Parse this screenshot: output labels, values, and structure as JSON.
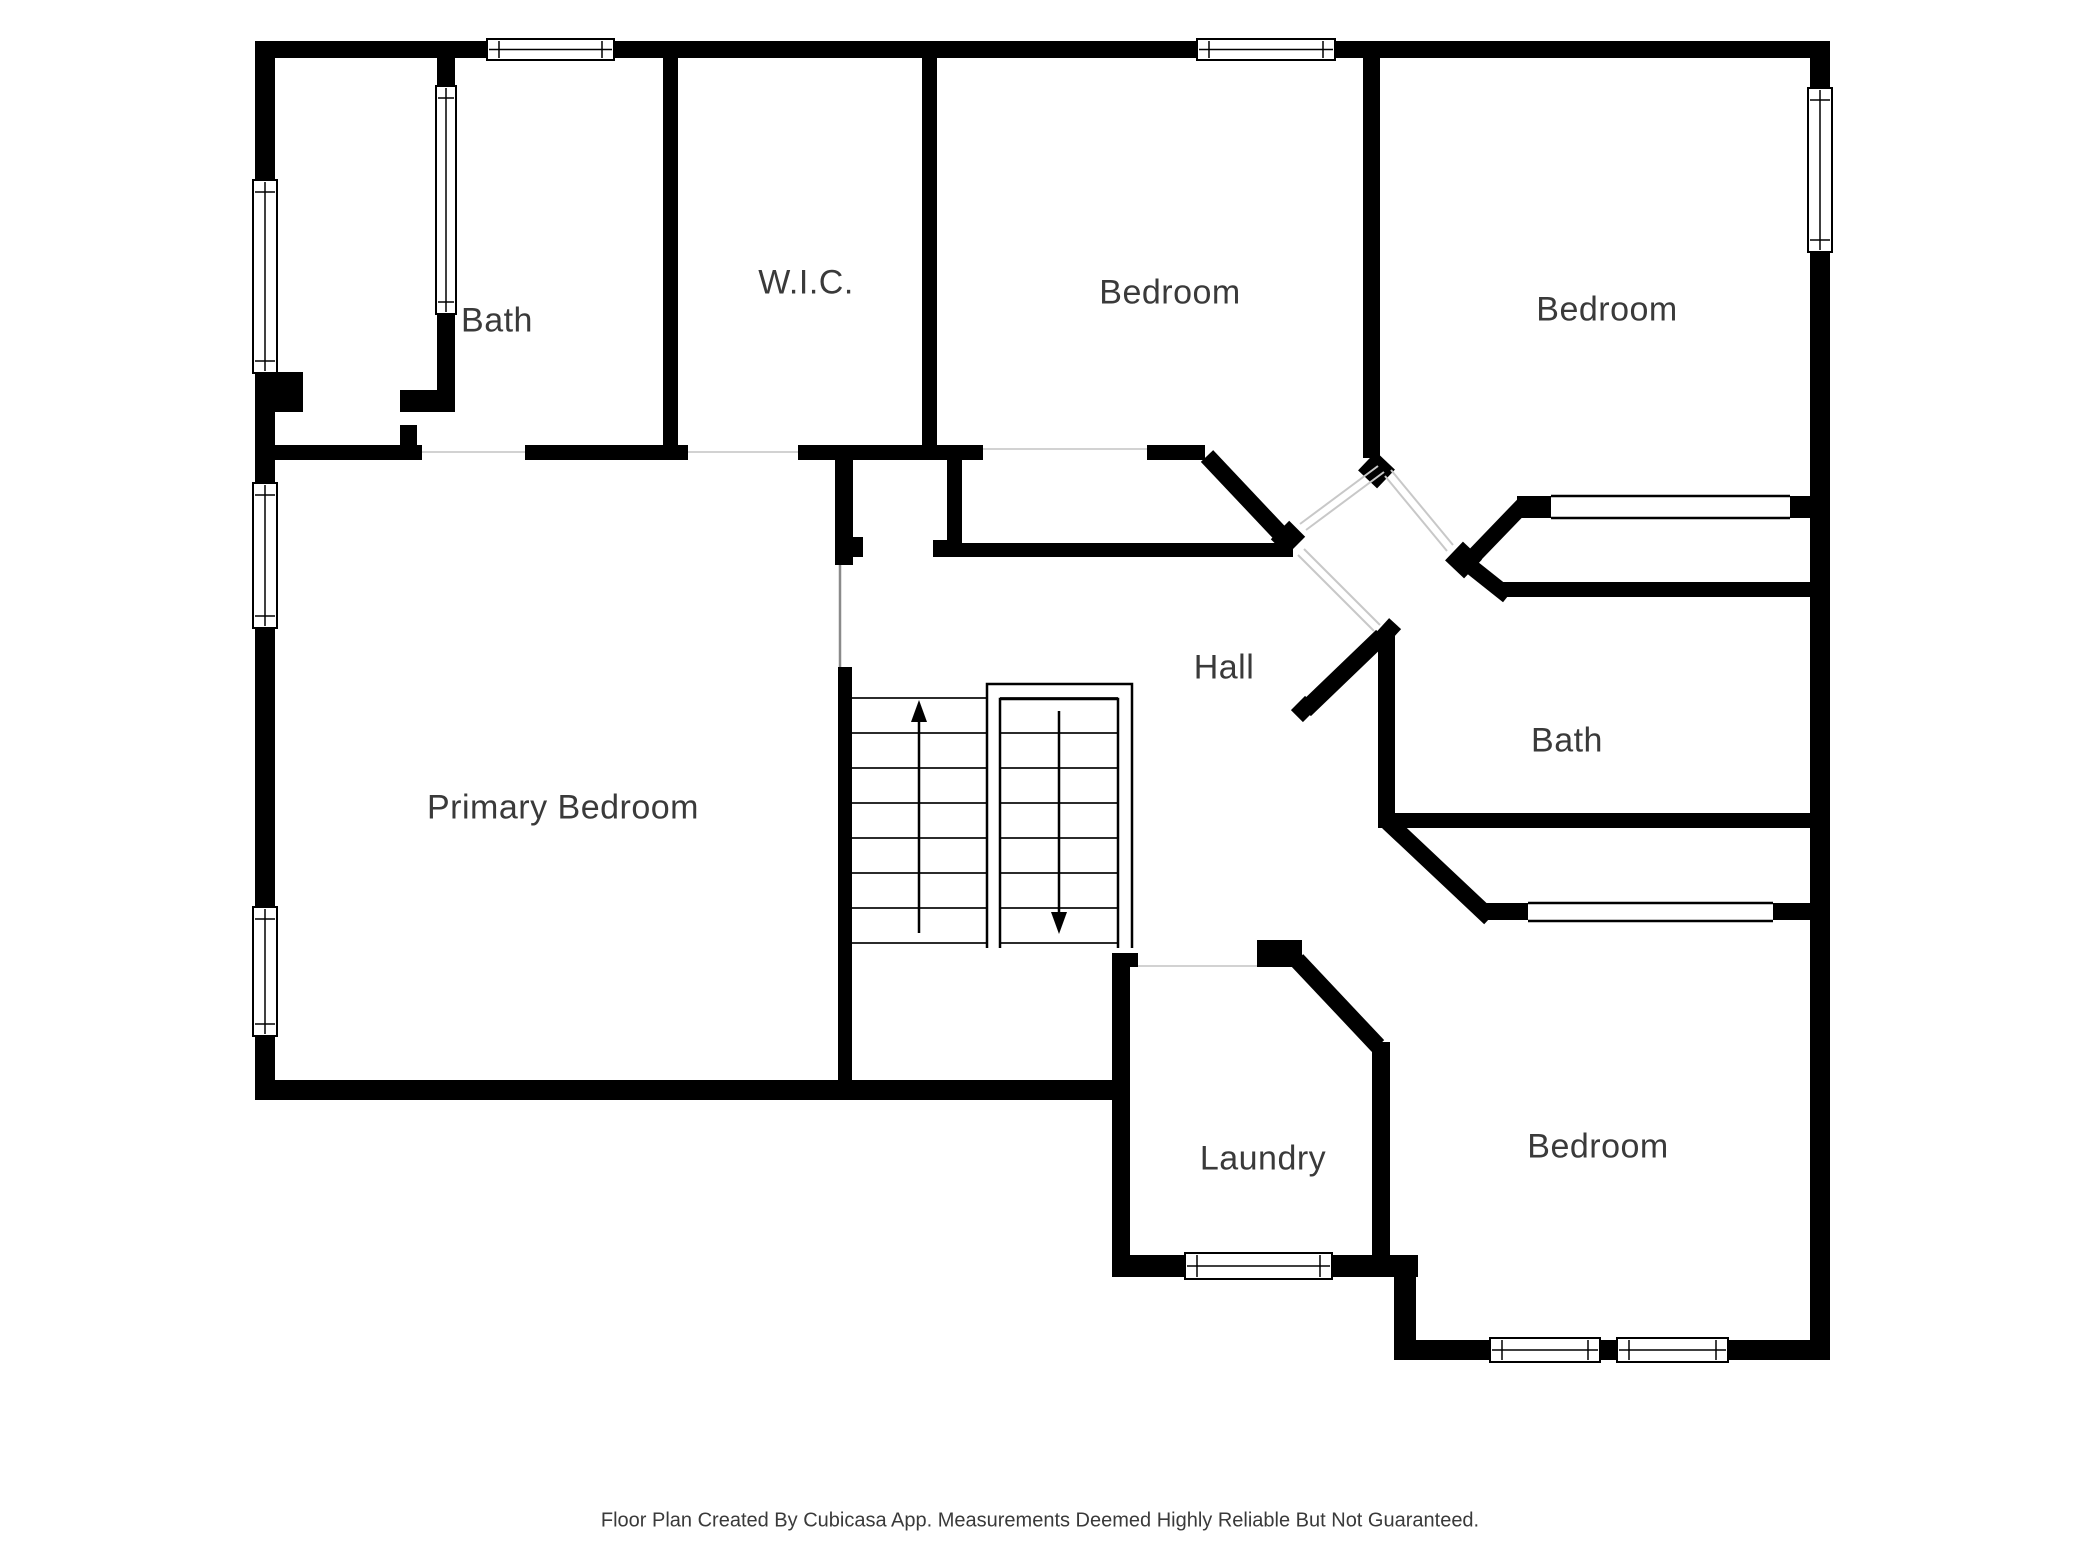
{
  "footer": {
    "text": "Floor Plan Created By Cubicasa App. Measurements Deemed Highly Reliable But Not Guaranteed.",
    "x": 1040,
    "y": 1521,
    "size": 20
  },
  "rooms": [
    {
      "id": "bath-upper",
      "label": "Bath",
      "x": 497,
      "y": 321,
      "size": 34
    },
    {
      "id": "wic",
      "label": "W.I.C.",
      "x": 806,
      "y": 283,
      "size": 34
    },
    {
      "id": "bedroom-top-middle",
      "label": "Bedroom",
      "x": 1170,
      "y": 293,
      "size": 34
    },
    {
      "id": "bedroom-top-right",
      "label": "Bedroom",
      "x": 1607,
      "y": 310,
      "size": 34
    },
    {
      "id": "primary-bedroom",
      "label": "Primary Bedroom",
      "x": 563,
      "y": 808,
      "size": 34
    },
    {
      "id": "hall",
      "label": "Hall",
      "x": 1224,
      "y": 668,
      "size": 34
    },
    {
      "id": "bath-right",
      "label": "Bath",
      "x": 1567,
      "y": 741,
      "size": 34
    },
    {
      "id": "laundry",
      "label": "Laundry",
      "x": 1263,
      "y": 1159,
      "size": 34
    },
    {
      "id": "bedroom-bottom",
      "label": "Bedroom",
      "x": 1598,
      "y": 1147,
      "size": 34
    }
  ],
  "plan": {
    "canvas": {
      "w": 2080,
      "h": 1560,
      "bg": "#ffffff"
    },
    "colors": {
      "wall": "#000000",
      "tread": "#2b2b2b",
      "threshold": "#d2d2d2",
      "leaf": "#c8c8c8",
      "frame": "#000000",
      "door_line": "#8a8a8a"
    },
    "walls": [
      [
        255,
        41,
        1575,
        17
      ],
      [
        255,
        41,
        20,
        1059
      ],
      [
        1810,
        41,
        20,
        1319
      ],
      [
        255,
        1080,
        875,
        20
      ],
      [
        1112,
        1255,
        306,
        22
      ],
      [
        1394,
        1277,
        22,
        83
      ],
      [
        1394,
        1340,
        436,
        20
      ],
      [
        663,
        58,
        15,
        387
      ],
      [
        922,
        58,
        15,
        400
      ],
      [
        1363,
        58,
        17,
        400
      ],
      [
        275,
        445,
        147,
        15
      ],
      [
        400,
        425,
        17,
        20
      ],
      [
        525,
        445,
        163,
        15
      ],
      [
        798,
        445,
        185,
        15
      ],
      [
        1147,
        445,
        58,
        15
      ],
      [
        947,
        458,
        15,
        99
      ],
      [
        933,
        540,
        14,
        17
      ],
      [
        962,
        543,
        331,
        14
      ],
      [
        835,
        458,
        18,
        107
      ],
      [
        853,
        537,
        10,
        20
      ],
      [
        838,
        667,
        14,
        413
      ],
      [
        1112,
        953,
        26,
        14
      ],
      [
        1112,
        953,
        18,
        324
      ],
      [
        1257,
        940,
        45,
        27
      ],
      [
        1372,
        1042,
        18,
        235
      ],
      [
        1378,
        633,
        17,
        180
      ],
      [
        1502,
        582,
        308,
        15
      ],
      [
        1378,
        813,
        432,
        15
      ],
      [
        1517,
        496,
        34,
        22
      ],
      [
        1790,
        496,
        20,
        22
      ],
      [
        1483,
        903,
        45,
        17
      ],
      [
        1773,
        903,
        37,
        17
      ],
      [
        437,
        58,
        18,
        30
      ],
      [
        437,
        313,
        18,
        99
      ],
      [
        400,
        390,
        37,
        22
      ],
      [
        275,
        372,
        28,
        40
      ]
    ],
    "diagonals": [
      [
        1207,
        456,
        1290,
        544,
        17
      ],
      [
        1367,
        461,
        1386,
        479,
        26
      ],
      [
        1280,
        530,
        1296,
        546,
        26
      ],
      [
        1454,
        551,
        1473,
        569,
        26
      ],
      [
        1471,
        559,
        1523,
        505,
        16
      ],
      [
        1469,
        565,
        1508,
        596,
        16
      ],
      [
        1381,
        627,
        1393,
        638,
        24
      ],
      [
        1305,
        710,
        1382,
        636,
        17
      ],
      [
        1298,
        703,
        1310,
        715,
        20
      ],
      [
        1388,
        822,
        1490,
        918,
        17
      ],
      [
        1297,
        960,
        1378,
        1046,
        17
      ]
    ],
    "windows": [
      [
        487,
        39,
        127,
        21,
        "h"
      ],
      [
        1197,
        39,
        138,
        21,
        "h"
      ],
      [
        253,
        180,
        24,
        193,
        "v"
      ],
      [
        253,
        483,
        24,
        145,
        "v"
      ],
      [
        253,
        907,
        24,
        129,
        "v"
      ],
      [
        1808,
        88,
        24,
        164,
        "v"
      ],
      [
        1185,
        1253,
        147,
        26,
        "h"
      ],
      [
        1490,
        1338,
        110,
        24,
        "h"
      ],
      [
        1617,
        1338,
        111,
        24,
        "h"
      ],
      [
        436,
        86,
        20,
        228,
        "v"
      ]
    ],
    "cased_openings": [
      [
        1551,
        494,
        239,
        26
      ],
      [
        1528,
        901,
        245,
        22
      ]
    ],
    "thresholds": [
      [
        422,
        452,
        525,
        452
      ],
      [
        688,
        452,
        798,
        452
      ],
      [
        983,
        449,
        1147,
        449
      ],
      [
        1138,
        966,
        1257,
        966
      ]
    ],
    "door_lines": [
      [
        840,
        565,
        840,
        667
      ]
    ],
    "door_leaves": [
      [
        1385,
        476,
        1447,
        551
      ],
      [
        1391,
        470,
        1453,
        545
      ],
      [
        1378,
        466,
        1300,
        524
      ],
      [
        1384,
        472,
        1306,
        530
      ],
      [
        1298,
        555,
        1374,
        631
      ],
      [
        1304,
        549,
        1380,
        625
      ]
    ],
    "stairs": {
      "left_flight": {
        "x1": 852,
        "x2": 987,
        "ys": [
          698,
          733,
          768,
          803,
          838,
          873,
          908,
          943
        ]
      },
      "right_flight": {
        "x1": 1000,
        "x2": 1118,
        "ys": [
          698,
          733,
          768,
          803,
          838,
          873,
          908,
          943
        ]
      },
      "rails": [
        "M 987 948 L 987 684 L 1132 684 L 1132 948",
        "M 1000 948 L 1000 699 L 1118 699 L 1118 948"
      ],
      "up_arrow": {
        "line": [
          919,
          933,
          919,
          713
        ],
        "head": [
          [
            911,
            722
          ],
          [
            927,
            722
          ],
          [
            919,
            700
          ]
        ]
      },
      "down_arrow": {
        "line": [
          1059,
          711,
          1059,
          921
        ],
        "head": [
          [
            1051,
            912
          ],
          [
            1067,
            912
          ],
          [
            1059,
            934
          ]
        ]
      }
    }
  }
}
